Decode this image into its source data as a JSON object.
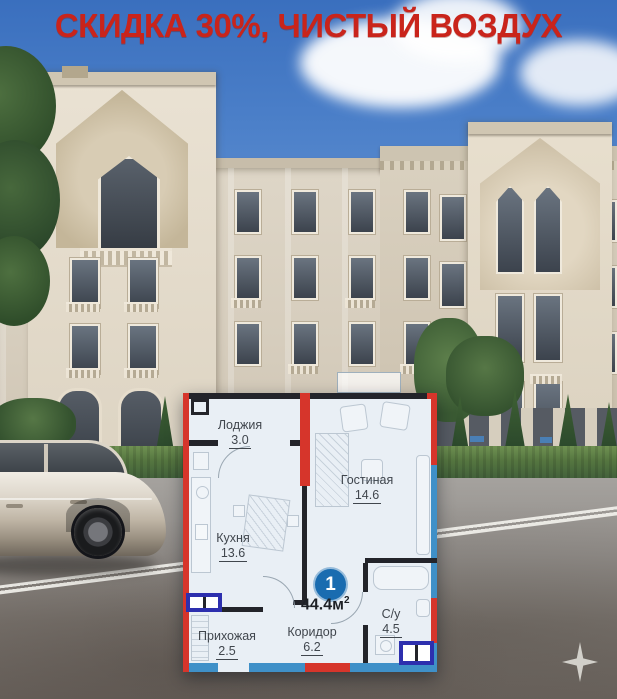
{
  "headline": {
    "text": "СКИДКА 30%, ЧИСТЫЙ ВОЗДУХ",
    "color": "#c9241b"
  },
  "floor_plan": {
    "unit": {
      "rooms_count": "1",
      "area_value": "44.4м",
      "area_sup": "2"
    },
    "rooms": [
      {
        "name": "Лоджия",
        "area": "3.0"
      },
      {
        "name": "Гостиная",
        "area": "14.6"
      },
      {
        "name": "Кухня",
        "area": "13.6"
      },
      {
        "name": "Прихожая",
        "area": "2.5"
      },
      {
        "name": "Коридор",
        "area": "6.2"
      },
      {
        "name": "С/у",
        "area": "4.5"
      }
    ],
    "colors": {
      "wall_red": "#d6352b",
      "wall_black": "#23242a",
      "border_blue": "#3f90c8",
      "window_symbol_blue": "#2d2fae",
      "badge_blue": "#1a6cb0",
      "floor": "#e9eff5"
    }
  }
}
